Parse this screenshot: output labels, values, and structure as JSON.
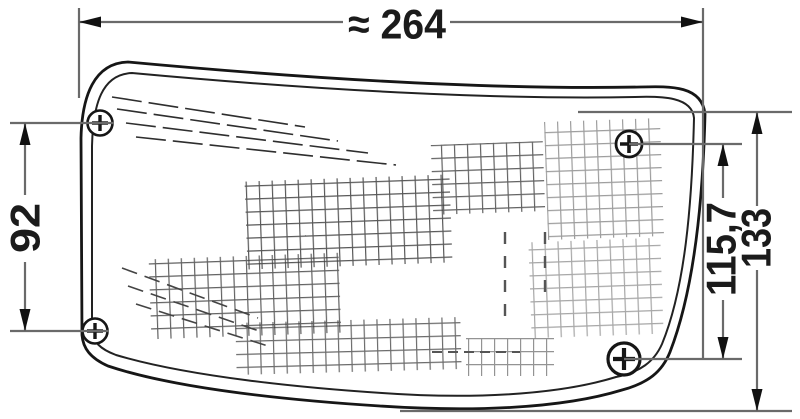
{
  "drawing": {
    "title": "lamp-dimension-drawing",
    "dimensions": {
      "overall_width": "≈ 264",
      "left_mount_height": "92",
      "right_mount_height": "115,7",
      "overall_height": "133"
    },
    "screws": {
      "count": 4,
      "symbol": "phillips-screw"
    },
    "colors": {
      "outline": "#161616",
      "dimension_lines": "#6a6a6a",
      "texture": "#3b3b3b",
      "background": "#ffffff",
      "text": "#1b1b1b"
    }
  }
}
